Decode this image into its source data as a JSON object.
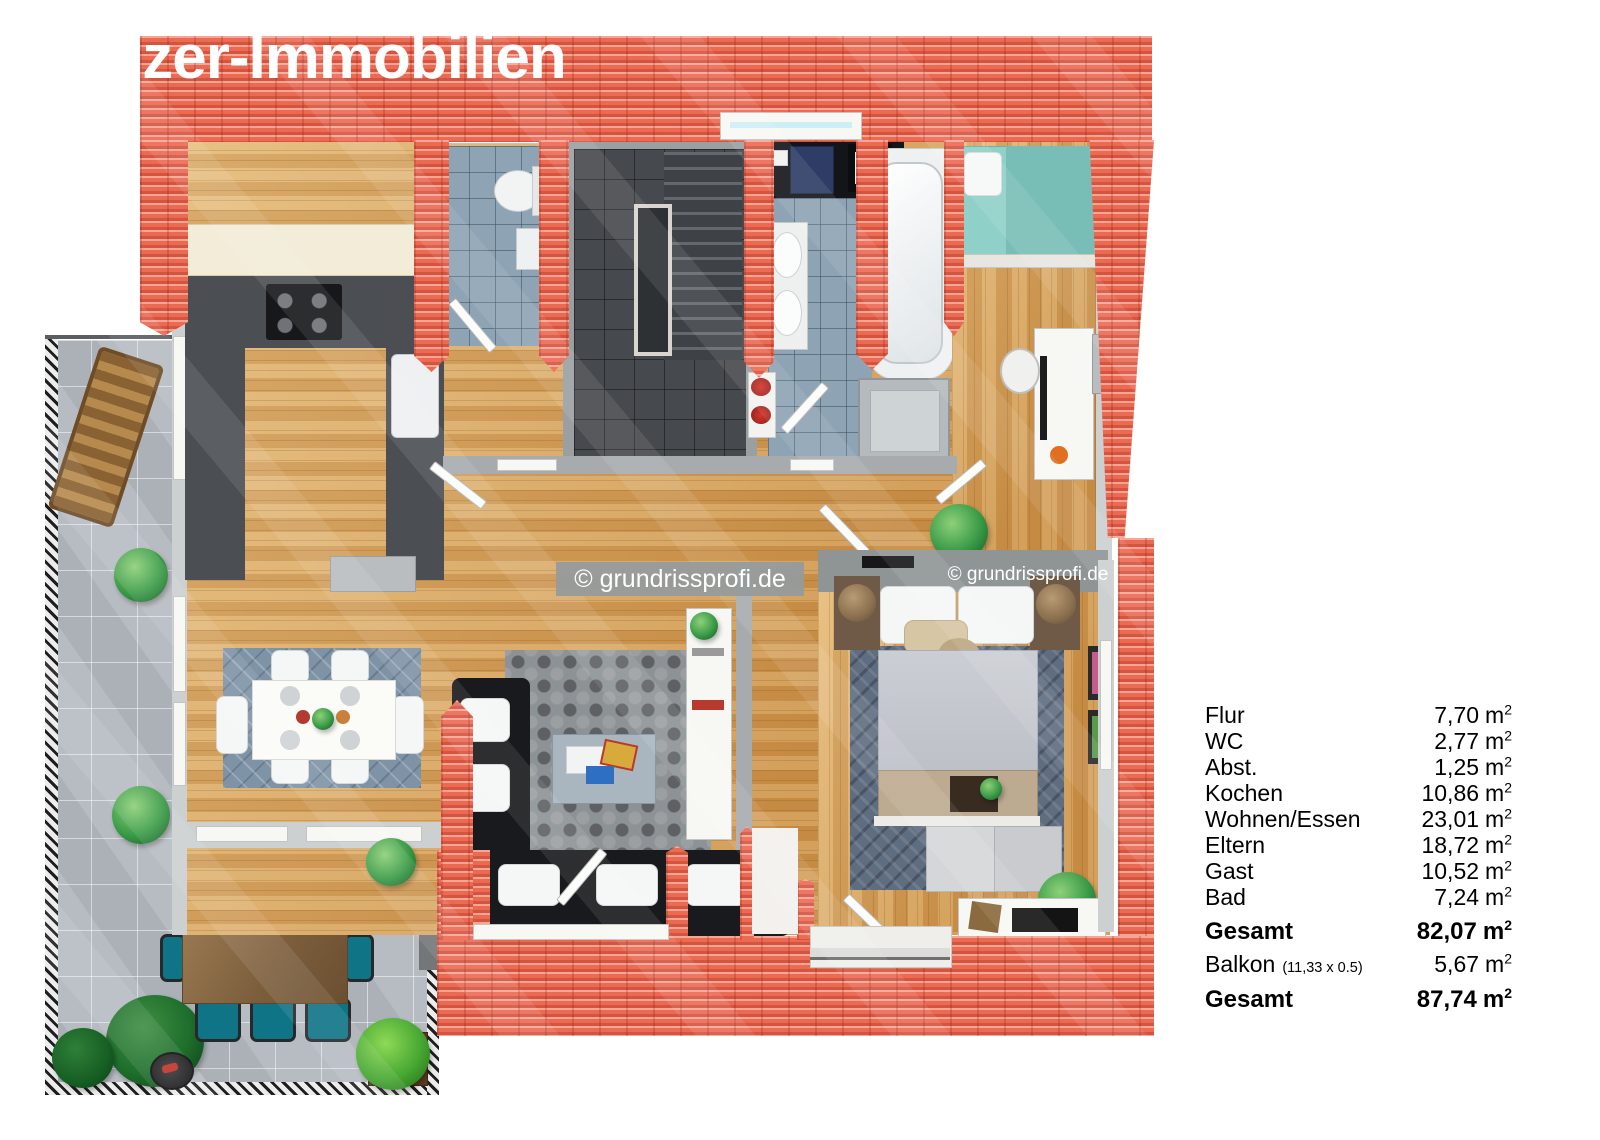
{
  "brand_watermark": "lzer-Immobilien",
  "copyright_watermark": "© grundrissprofi.de",
  "area_table": {
    "unit_base": "m",
    "unit_sup": "2",
    "rows": [
      {
        "label": "Flur",
        "value": "7,70"
      },
      {
        "label": "WC",
        "value": "2,77"
      },
      {
        "label": "Abst.",
        "value": "1,25"
      },
      {
        "label": "Kochen",
        "value": "10,86"
      },
      {
        "label": "Wohnen/Essen",
        "value": "23,01"
      },
      {
        "label": "Eltern",
        "value": "18,72"
      },
      {
        "label": "Gast",
        "value": "10,52"
      },
      {
        "label": "Bad",
        "value": "7,24"
      },
      {
        "label": "Gesamt",
        "value": "82,07"
      },
      {
        "label": "Balkon",
        "note": "(11,33 x 0.5)",
        "value": "5,67"
      },
      {
        "label": "Gesamt",
        "value": "87,74"
      }
    ]
  },
  "colors": {
    "roof": "#ed6b54",
    "wood_floor": "#d79e52",
    "bath_tile": "#8ea3b3",
    "terrace": "#b7bcc2",
    "chair_teal": "#0f7586"
  }
}
